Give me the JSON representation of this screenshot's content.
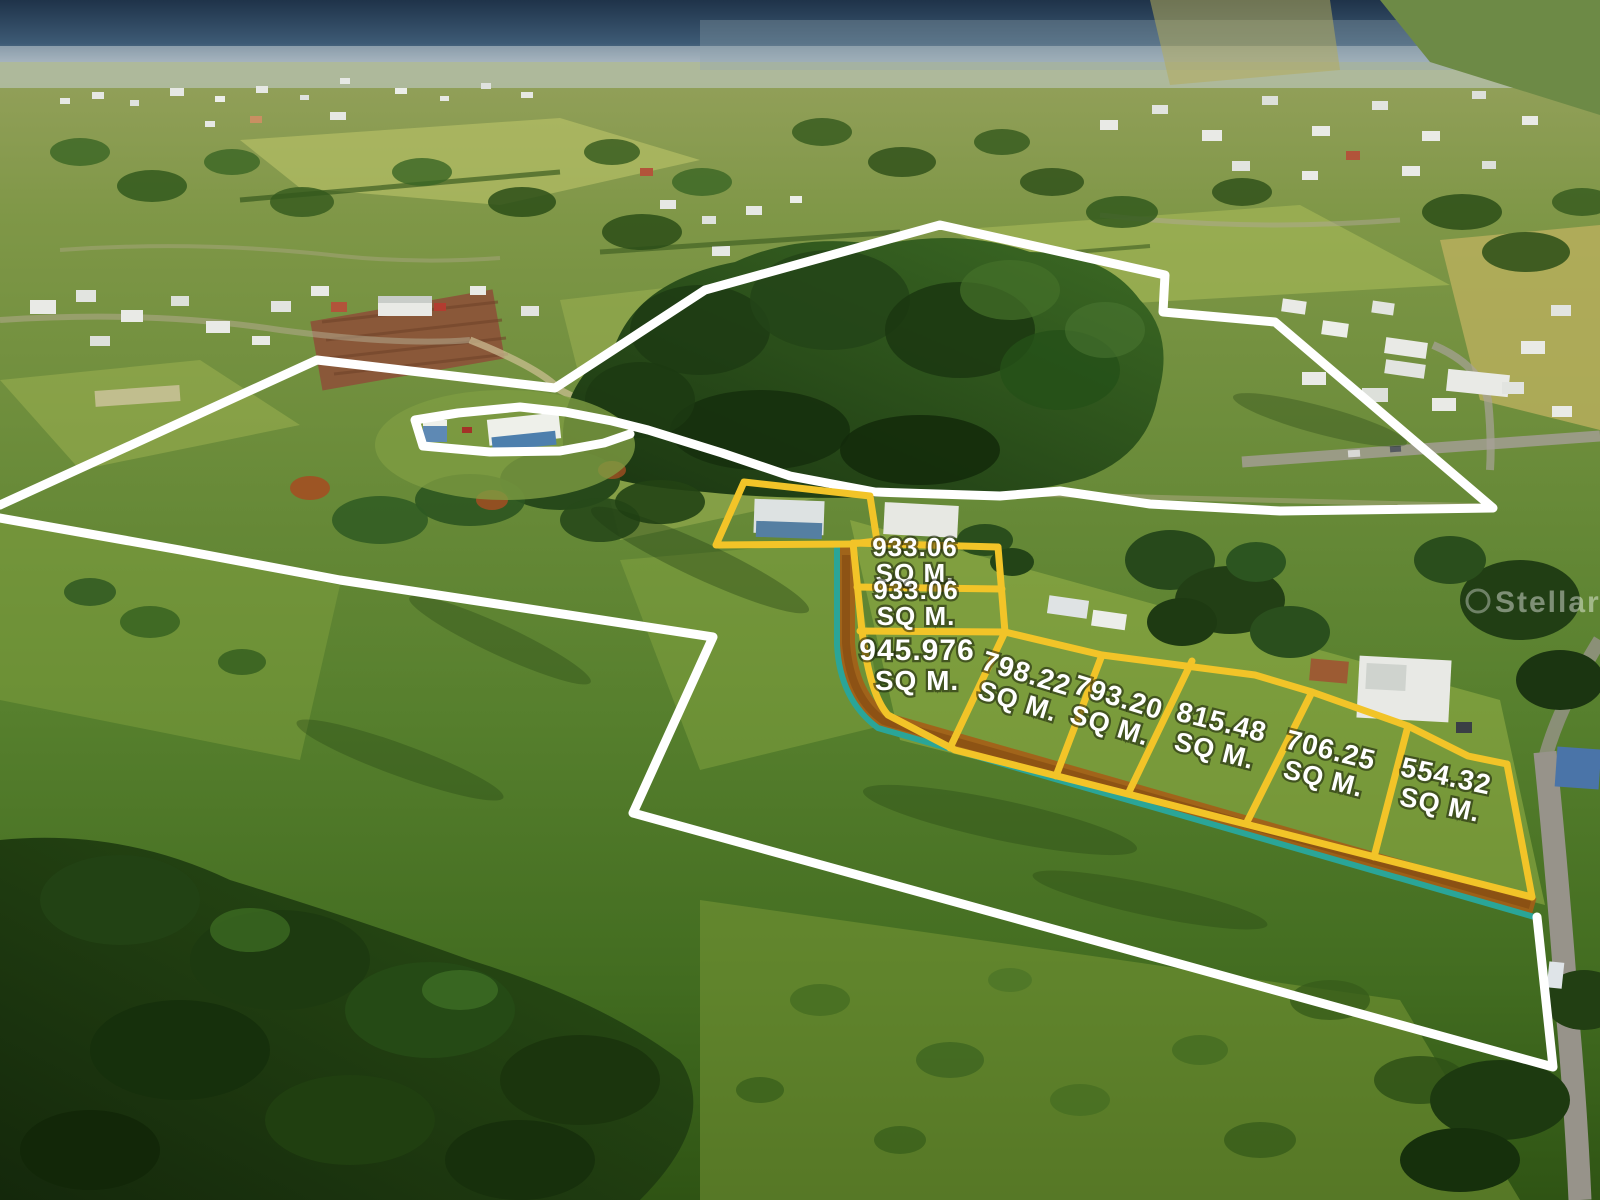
{
  "scene": {
    "type": "aerial-drone-photo-with-lot-overlay",
    "description_labels_visible": true
  },
  "watermark": "StellarMLS",
  "lots": [
    {
      "area": "933.06",
      "unit": "SQ M."
    },
    {
      "area": "933.06",
      "unit": "SQ M."
    },
    {
      "area": "945.976",
      "unit": "SQ M."
    },
    {
      "area": "798.22",
      "unit": "SQ M."
    },
    {
      "area": "793.20",
      "unit": "SQ M."
    },
    {
      "area": "815.48",
      "unit": "SQ M."
    },
    {
      "area": "706.25",
      "unit": "SQ M."
    },
    {
      "area": "554.32",
      "unit": "SQ M."
    }
  ],
  "overlay_colors": {
    "parcel_boundary": "#ffffff",
    "lot_lines": "#f2c428",
    "frontage_line": "#2aa598",
    "dirt_path": "#a55e17"
  }
}
